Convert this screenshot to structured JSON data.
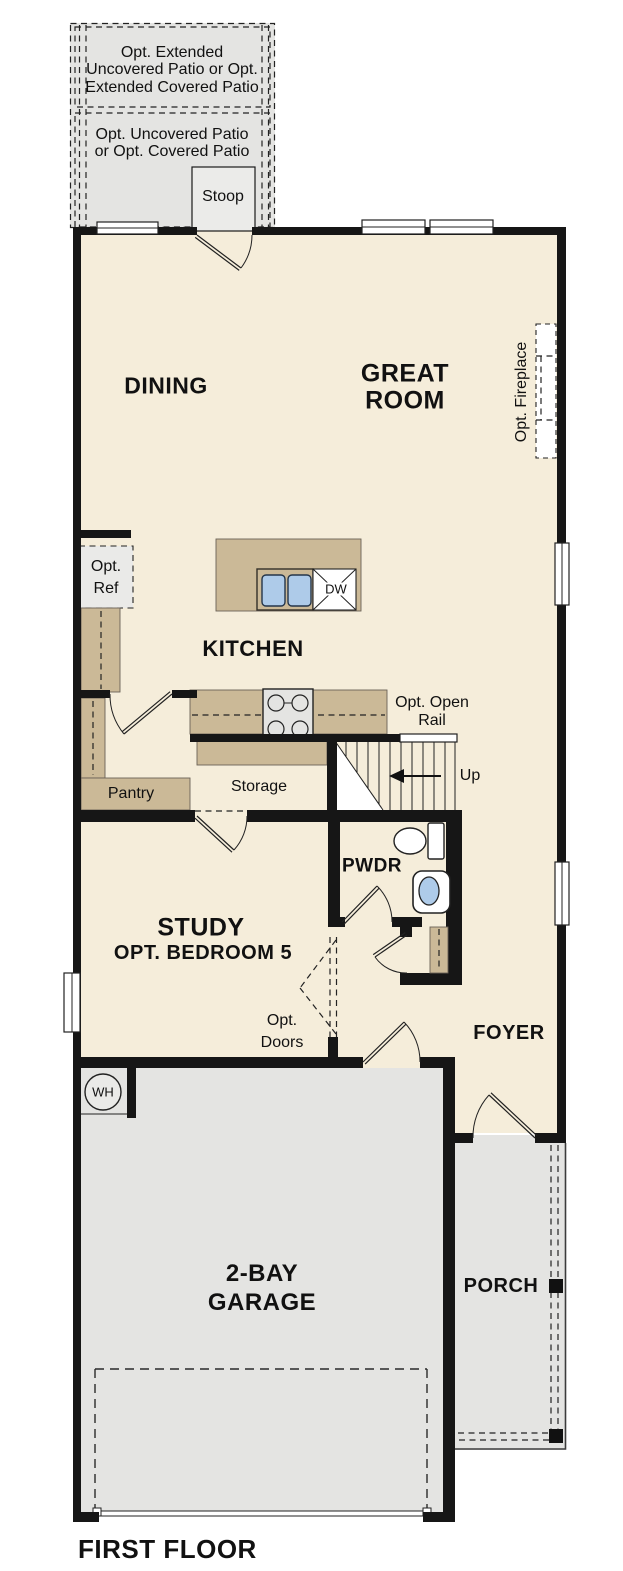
{
  "colors": {
    "wall": "#161616",
    "floor": "#f5edda",
    "exterior": "#e4e4e2",
    "stoop_fill": "#ebebe9",
    "cabinet": "#cbb997",
    "fixture_blue": "#aecbe9",
    "background": "#ffffff"
  },
  "labels": {
    "patio_extended": [
      "Opt. Extended",
      "Uncovered Patio or Opt.",
      "Extended Covered Patio"
    ],
    "patio": [
      "Opt. Uncovered Patio",
      "or Opt. Covered Patio"
    ],
    "stoop": "Stoop",
    "dining": "DINING",
    "great_room": [
      "GREAT",
      "ROOM"
    ],
    "opt_fireplace": "Opt. Fireplace",
    "opt_ref": [
      "Opt.",
      "Ref"
    ],
    "kitchen": "KITCHEN",
    "dishwasher": "DW",
    "opt_open_rail": [
      "Opt. Open",
      "Rail"
    ],
    "up": "Up",
    "pantry": "Pantry",
    "storage": "Storage",
    "powder": "PWDR",
    "study": [
      "STUDY",
      "OPT. BEDROOM 5"
    ],
    "opt_doors": [
      "Opt.",
      "Doors"
    ],
    "foyer": "FOYER",
    "water_heater": "WH",
    "garage": [
      "2-BAY",
      "GARAGE"
    ],
    "porch": "PORCH",
    "floor_title": "FIRST FLOOR"
  }
}
